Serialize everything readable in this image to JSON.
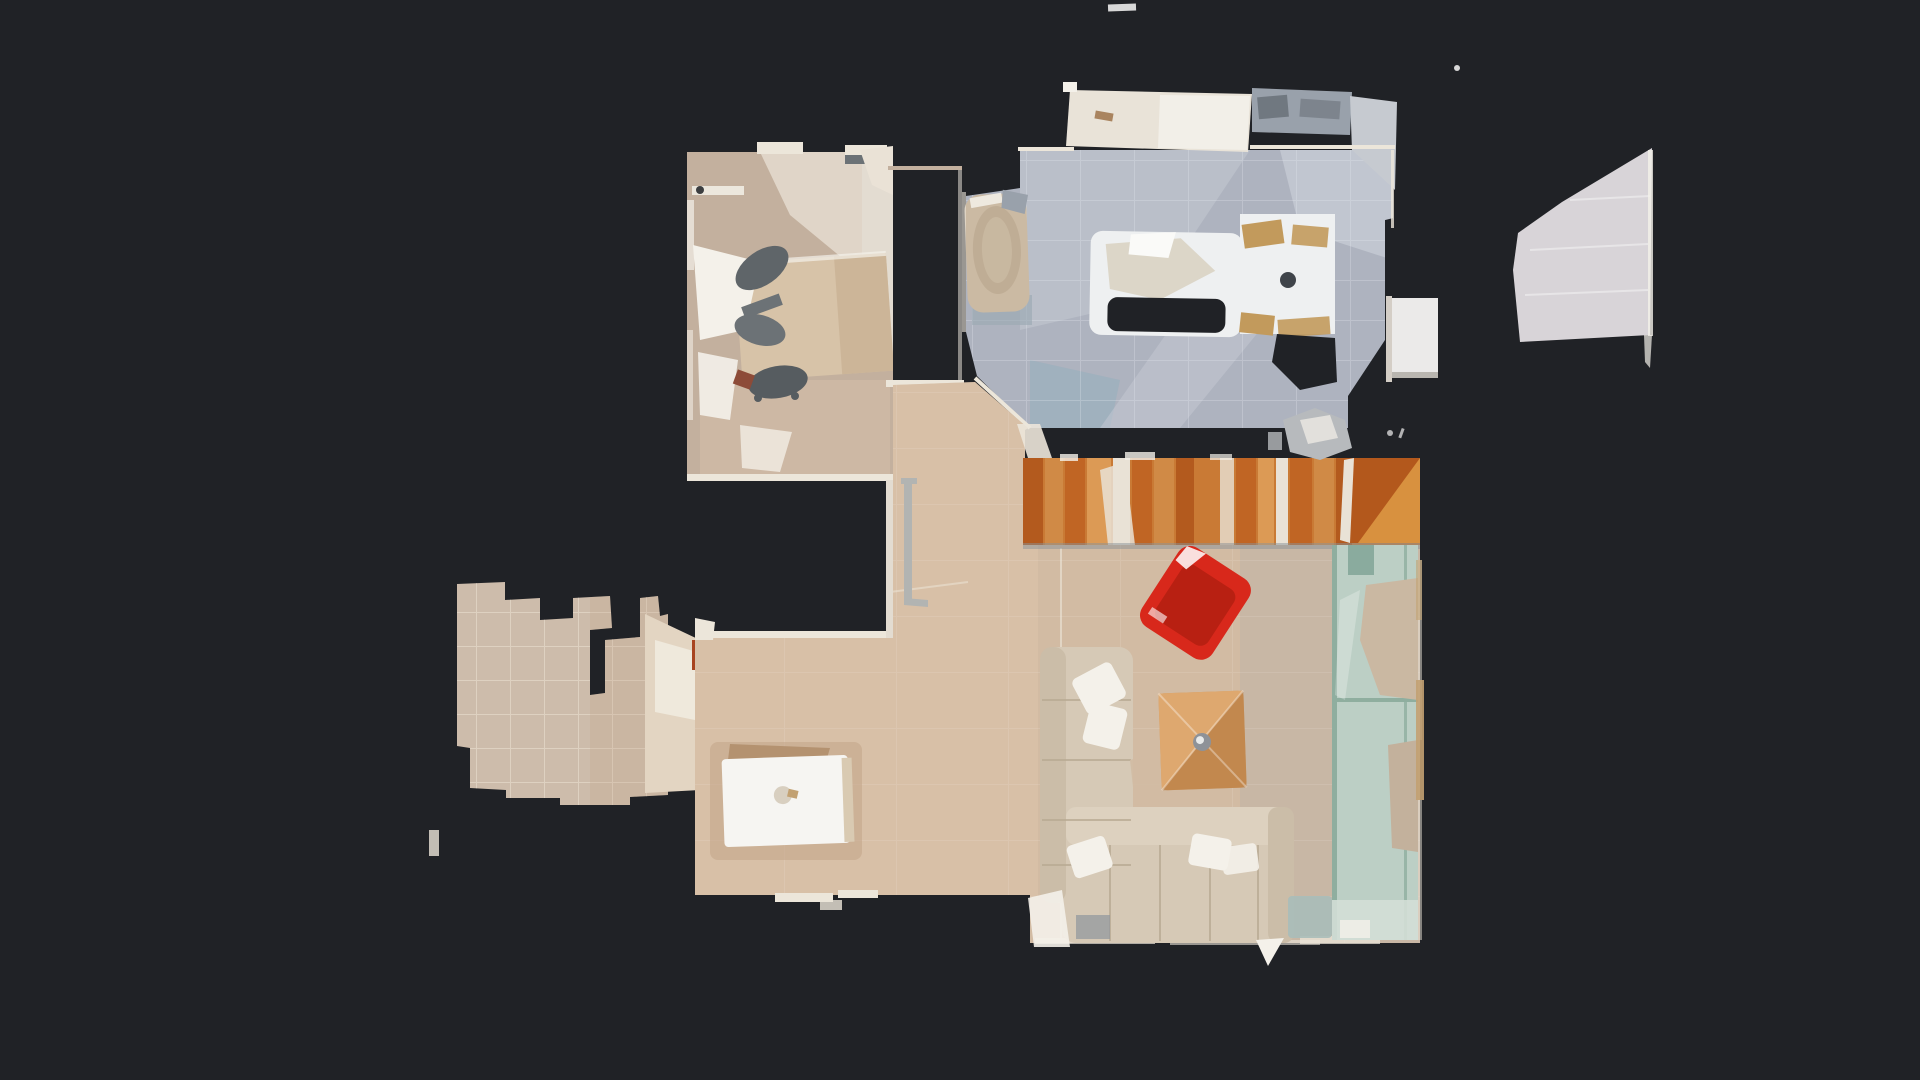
{
  "scene": {
    "kind": "top-down 3d floor plan scan (dollhouse view)",
    "rooms": [
      {
        "id": "bedroom-office",
        "contents": [
          "desk",
          "office-chairs",
          "bed-linen",
          "wardrobe"
        ]
      },
      {
        "id": "bathroom",
        "contents": [
          "bathtub",
          "shower-tub",
          "washing-machine",
          "vanity-counter",
          "sink-fixtures"
        ]
      },
      {
        "id": "hallway",
        "contents": [
          "railing"
        ]
      },
      {
        "id": "staircase",
        "contents": [
          "wood-steps"
        ]
      },
      {
        "id": "living-room",
        "contents": [
          "sectional-sofa",
          "red-armchair",
          "coffee-table",
          "glass-partition"
        ]
      },
      {
        "id": "dining-area",
        "contents": [
          "dining-table",
          "area-rug"
        ]
      },
      {
        "id": "terrace",
        "contents": [
          "tile-floor"
        ]
      },
      {
        "id": "balcony-fragment",
        "contents": []
      }
    ]
  },
  "colors": {
    "background": "#202226",
    "wallWhite": "#ece6da",
    "pillowWhite": "#f4f1ea",
    "bedroomFloor": "#c3b09e",
    "bedroomLight": "#eae2d6",
    "wardrobeBand": "#e3dcd1",
    "deskWood": "#d7c3a8",
    "deskWoodDark": "#c9b193",
    "chairGrey": "#5f6569",
    "chairGreyLight": "#6c7276",
    "chairGreyDark": "#565c60",
    "rustBrown": "#8d4b38",
    "poleBeige": "#ece7dd",
    "poleDot": "#3c3e40",
    "bathFloor": "#aeb3bf",
    "bathFloorLight": "#c6cad4",
    "bathFloorPale": "#bdc2cc",
    "bathFloorBlue": "#9db0bd",
    "counterWhite": "#e9e3d8",
    "counterBright": "#f2efe8",
    "fixtureGrey": "#99a1ab",
    "fixtureGreyDark": "#707880",
    "fixtureGreyLight": "#c6cad0",
    "tubBeige": "#cbbaa3",
    "tubInner": "#bfad95",
    "tubSkirt": "#9aa8b2",
    "fixtureWhite": "#eef0f1",
    "crumpleBeige": "#dcd6c8",
    "crumpleBright": "#fafaf8",
    "tanWood": "#c29a5c",
    "knobDark": "#3f444a",
    "doorWhite": "#ebeae9",
    "doorFrame": "#d4cec6",
    "doorEdge": "#b9b6b0",
    "greyBlob": "#b7babd",
    "stairOrange1": "#b35a1e",
    "stairOrange2": "#d08a46",
    "stairOrange3": "#c06524",
    "stairOrange4": "#dc9a55",
    "stairBase": "#c97a35",
    "stairGapWhite": "#e9e2d6",
    "stairRampLight": "#d8913f",
    "stairRampDark": "#b3581c",
    "stairShadow": "#8a9198",
    "livingFloor": "#d2bba3",
    "livingFloorWarm": "#e0c8ae",
    "livingFloorGrey": "#bfb4a8",
    "railGrey": "#b2b4b2",
    "sofaBeige": "#d6c9b6",
    "sofaArm": "#cbbda8",
    "sofaBack": "#ddd1bf",
    "redChair": "#d8281b",
    "redChairDark": "#b51f12",
    "tableWood": "#cf965c",
    "tableWoodLight": "#e0ab72",
    "tableWoodDark": "#b97f45",
    "knobGrey": "#8e9298",
    "knobRing": "#e8eaea",
    "glassGreen": "#bccfc5",
    "glassLine": "#8fae9f",
    "glassHole": "#cab8a2",
    "glassHole2": "#c3b19c",
    "glassBottom": "#d3ded6",
    "dividerTeal": "#8aab9e",
    "tanSliver": "#c2a172",
    "sailGrey": "#d8d4d8",
    "terraceTile": "#cdbcab",
    "connectorBeige": "#e3d5c2",
    "connectorWhite": "#efe9dc",
    "doorRust": "#a84420",
    "rugTan": "#c2a488",
    "rugCrumple": "#a9845f",
    "tableWhite": "#f6f5f2",
    "tableShadow": "#d9cab2",
    "tableObject": "#d8cfc0",
    "greyGreen": "#a9bcb9",
    "shadowGrey": "#8e969c",
    "speckWhite": "#d8d8d8"
  }
}
